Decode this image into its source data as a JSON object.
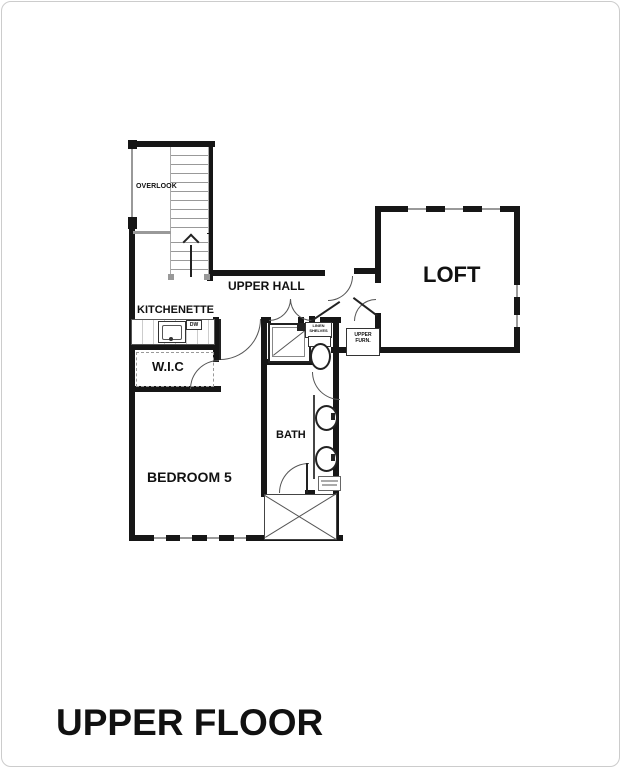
{
  "title": "UPPER FLOOR",
  "rooms": {
    "overlook": "OVERLOOK",
    "upper_hall": "UPPER HALL",
    "kitchenette": "KITCHENETTE",
    "loft": "LOFT",
    "wic": "W.I.C",
    "bedroom": "BEDROOM 5",
    "bath": "BATH"
  },
  "closet_labels": {
    "linen_line1": "LINEN",
    "linen_line2": "SHELVES",
    "furnace_line1": "UPPER",
    "furnace_line2": "FURN."
  },
  "appliances": {
    "dishwasher": "DW"
  },
  "colors": {
    "wall": "#161616",
    "fixture_line": "#555",
    "detail_grey": "#999",
    "background": "#ffffff",
    "card_border": "#cccccc"
  }
}
